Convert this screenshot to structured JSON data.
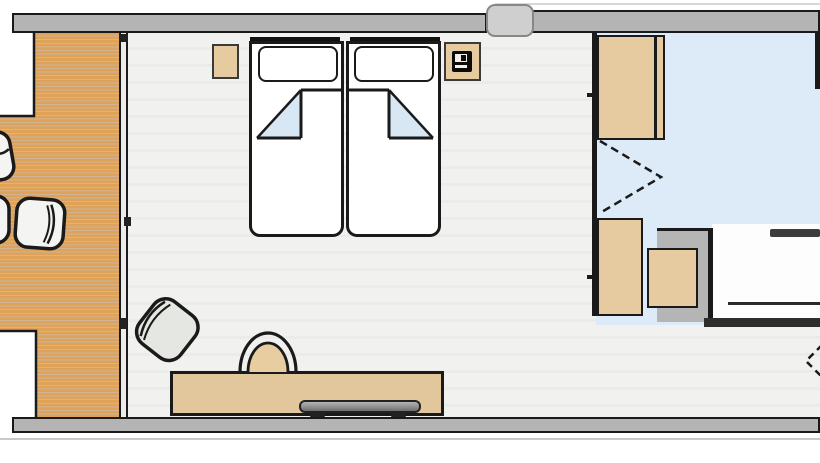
{
  "title": "Hotel room floor plan with twin beds, balcony deck and bathroom",
  "colors": {
    "wall_gray": "#b4b4b4",
    "outline": "#1a1a1a",
    "deck_wood": "#dfa259",
    "plank_line": "rgba(150,90,22,0.45)",
    "floor": "#f1f1f0",
    "furniture_tan": "#e6cba1",
    "bathroom_blue": "#dcebf7",
    "blanket_fold_blue": "#d7e7f4",
    "chair_gray": "#e4e7e2",
    "bed_white": "#ffffff"
  },
  "rooms": [
    {
      "name": "balcony deck",
      "floor": "wood planks",
      "position": "left"
    },
    {
      "name": "bedroom",
      "floor": "light grey",
      "position": "center"
    },
    {
      "name": "bathroom",
      "floor": "blue tile",
      "position": "right"
    },
    {
      "name": "entry corridor",
      "floor": "light grey",
      "position": "bottom right"
    }
  ],
  "furniture": [
    {
      "name": "twin bed left",
      "details": "pillow and duvet with folded corner"
    },
    {
      "name": "twin bed right",
      "details": "pillow and duvet with folded corner"
    },
    {
      "name": "nightstand left"
    },
    {
      "name": "nightstand right",
      "details": "telephone on top"
    },
    {
      "name": "upper wardrobe"
    },
    {
      "name": "lower closet"
    },
    {
      "name": "drawer chest"
    },
    {
      "name": "bathtub",
      "details": "cut off at right edge"
    },
    {
      "name": "desk sideboard"
    },
    {
      "name": "flat tv on desk"
    },
    {
      "name": "desk chair"
    },
    {
      "name": "armchair"
    },
    {
      "name": "deck chair"
    },
    {
      "name": "deck chair partial",
      "details": "cut off at left edge"
    },
    {
      "name": "deck table partial",
      "details": "cut off at left edge"
    }
  ],
  "doors": [
    {
      "name": "sliding window",
      "location": "between deck and bedroom",
      "style": "solid with handle marks"
    },
    {
      "name": "bifold closet door",
      "location": "bathroom wardrobe",
      "style": "dashed chevron"
    },
    {
      "name": "entry door swing",
      "location": "bottom right edge",
      "style": "dashed chevron"
    }
  ]
}
